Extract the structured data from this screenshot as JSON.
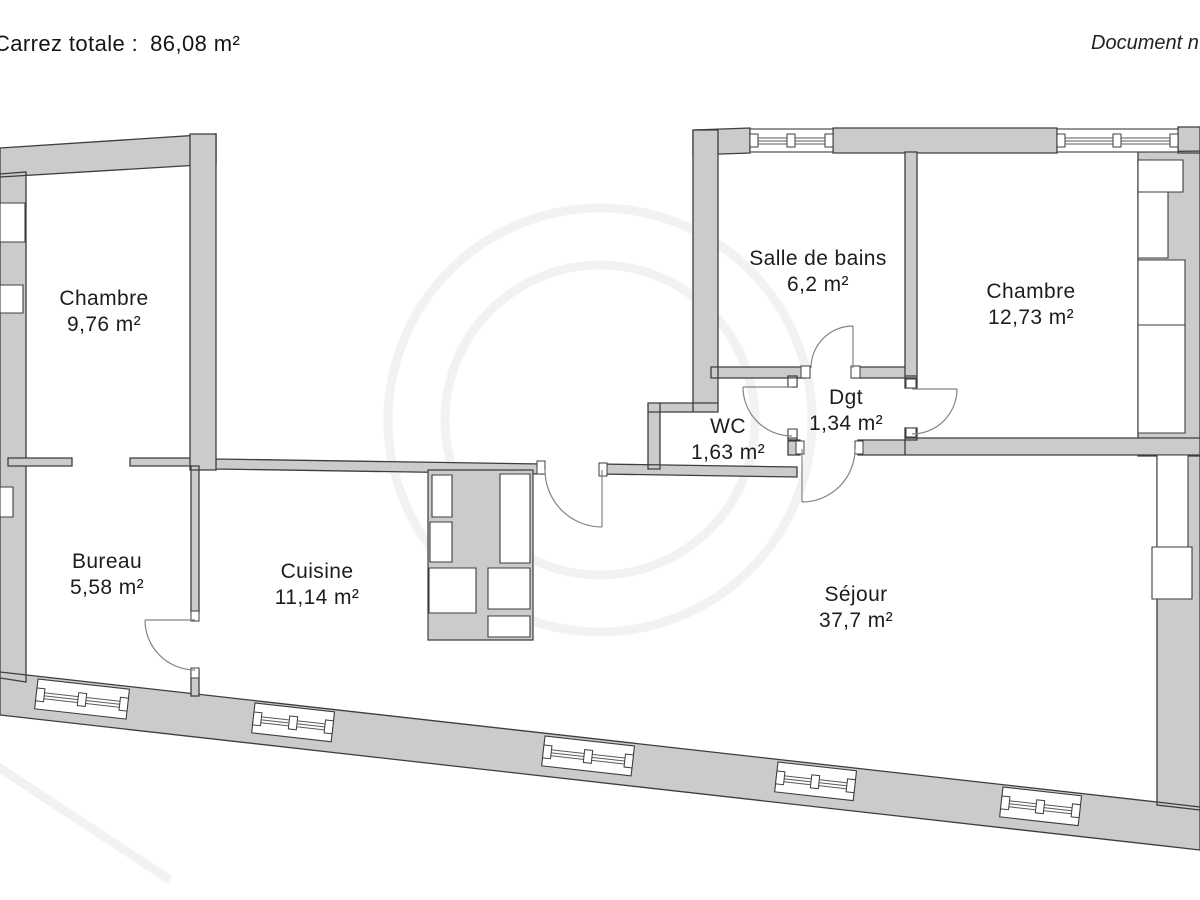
{
  "header": {
    "area_label": "Carrez totale :",
    "area_value": "86,08 m²",
    "document_note": "Document n"
  },
  "rooms": {
    "chambre1": {
      "name": "Chambre",
      "area": "9,76 m²"
    },
    "salle_de_bains": {
      "name": "Salle de bains",
      "area": "6,2 m²"
    },
    "chambre2": {
      "name": "Chambre",
      "area": "12,73 m²"
    },
    "wc": {
      "name": "WC",
      "area": "1,63 m²"
    },
    "degagement": {
      "name": "Dgt",
      "area": "1,34 m²"
    },
    "bureau": {
      "name": "Bureau",
      "area": "5,58 m²"
    },
    "cuisine": {
      "name": "Cuisine",
      "area": "11,14 m²"
    },
    "sejour": {
      "name": "Séjour",
      "area": "37,7 m²"
    }
  },
  "colors": {
    "wall_fill": "#cbcbcb",
    "wall_outline": "#3d3d3d",
    "door_stroke": "#848484",
    "text": "#1d1d1d"
  }
}
